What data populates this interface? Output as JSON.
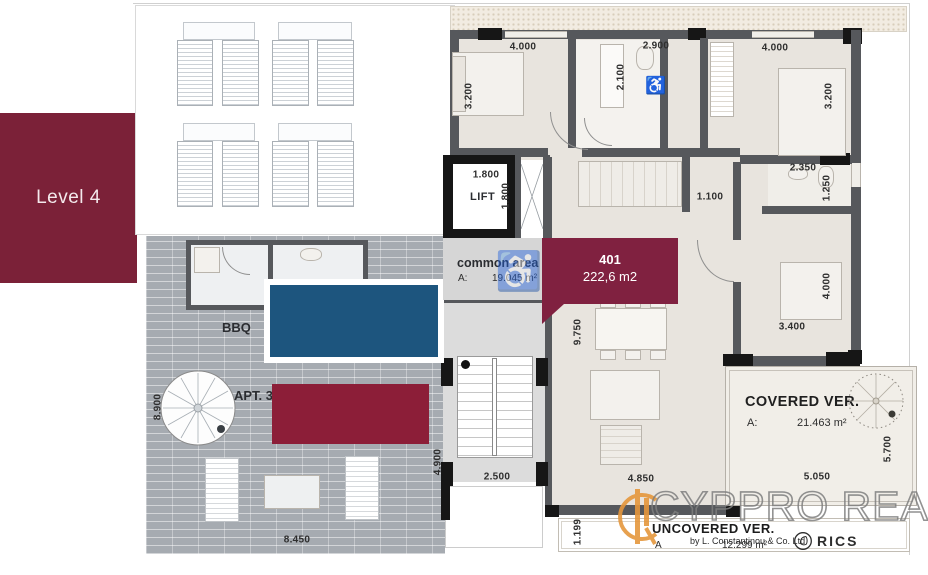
{
  "level": {
    "label": "Level 4"
  },
  "unit_badge": {
    "number": "401",
    "area": "222,6 m2"
  },
  "lift": {
    "label": "LIFT"
  },
  "common_area": {
    "title": "common area",
    "area_prefix": "A:",
    "area_value": "19.045 m²"
  },
  "covered_veranda": {
    "title": "COVERED VER.",
    "area_prefix": "A:",
    "area_value": "21.463 m²"
  },
  "uncovered_veranda": {
    "title": "UNCOVERED VER.",
    "area_prefix": "A",
    "area_value": "12.299 m²"
  },
  "terrace": {
    "bbq_label": "BBQ",
    "apartment_label": "APT. 3"
  },
  "branding": {
    "name": "CYPPRO REALTY",
    "byline": "by L. Constantinou & Co. Ltd",
    "rics_label": "RICS"
  },
  "icons": {
    "accessible": "♿"
  },
  "colors": {
    "maroon": "#7b2138",
    "badge_maroon": "#802140",
    "pool_blue": "#1d557e",
    "terrace_gray": "#a6abb1",
    "room_beige": "#e8e4de",
    "wall_gray": "#56585c",
    "accent_orange": "#e5973c"
  },
  "dimensions": [
    {
      "label": "4.000",
      "x": 523,
      "y": 47,
      "vertical": false
    },
    {
      "label": "3.200",
      "x": 469,
      "y": 96,
      "vertical": true
    },
    {
      "label": "2.100",
      "x": 621,
      "y": 77,
      "vertical": true
    },
    {
      "label": "2.900",
      "x": 656,
      "y": 46,
      "vertical": false
    },
    {
      "label": "4.000",
      "x": 775,
      "y": 48,
      "vertical": false
    },
    {
      "label": "3.200",
      "x": 829,
      "y": 96,
      "vertical": true
    },
    {
      "label": "1.800",
      "x": 486,
      "y": 175,
      "vertical": false
    },
    {
      "label": "1.800",
      "x": 506,
      "y": 196,
      "vertical": true
    },
    {
      "label": "2.350",
      "x": 803,
      "y": 168,
      "vertical": false
    },
    {
      "label": "1.250",
      "x": 827,
      "y": 188,
      "vertical": true
    },
    {
      "label": "1.100",
      "x": 710,
      "y": 197,
      "vertical": false
    },
    {
      "label": "4.000",
      "x": 827,
      "y": 286,
      "vertical": true
    },
    {
      "label": "3.400",
      "x": 792,
      "y": 327,
      "vertical": false
    },
    {
      "label": "9.750",
      "x": 578,
      "y": 332,
      "vertical": true
    },
    {
      "label": "2.500",
      "x": 497,
      "y": 477,
      "vertical": false
    },
    {
      "label": "4.850",
      "x": 641,
      "y": 479,
      "vertical": false
    },
    {
      "label": "5.050",
      "x": 817,
      "y": 477,
      "vertical": false
    },
    {
      "label": "5.700",
      "x": 888,
      "y": 449,
      "vertical": true
    },
    {
      "label": "1.199",
      "x": 578,
      "y": 532,
      "vertical": true
    },
    {
      "label": "8.450",
      "x": 297,
      "y": 540,
      "vertical": false
    },
    {
      "label": "8.900",
      "x": 158,
      "y": 407,
      "vertical": true
    },
    {
      "label": "4.900",
      "x": 438,
      "y": 462,
      "vertical": true
    }
  ]
}
